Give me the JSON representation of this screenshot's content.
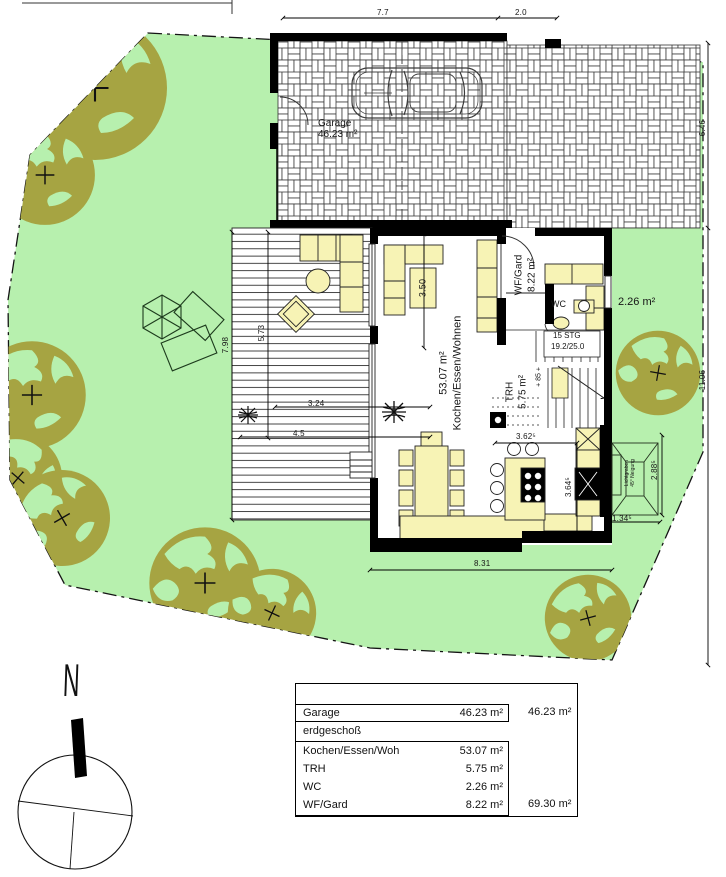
{
  "site": {
    "garage_label": "Garage",
    "garage_area": "46.23 m²",
    "rooms": {
      "living": {
        "area": "53.07 m²",
        "name": "Kochen/Essen/Wohnen"
      },
      "wf_gard": {
        "name": "WF/Gard",
        "area": "8.22 m²"
      },
      "wc": {
        "name": "WC",
        "area": "2.26 m²"
      },
      "trh": {
        "name": "TRH",
        "area": "5.75 m²"
      }
    },
    "stairs": {
      "line1": "15 STG",
      "line2": "19.2/25.0",
      "level_note": "+ 85 +"
    },
    "canopy": {
      "line1": "Lichtgraben",
      "line2": "45° Neigung"
    },
    "compass": "N",
    "dimensions": {
      "garage_width": "7.7",
      "gate_width": "2.0",
      "right_upper": "6.46",
      "right_lower": "11.06",
      "terrace_height": "7.98",
      "terrace_inner": "5.73",
      "terrace_w1": "3.24",
      "terrace_w2": "4.5",
      "living_table": "3.50",
      "kitchen_width": "3.62⁵",
      "kitchen_height": "3.64⁵",
      "house_width": "8.31",
      "canopy_height": "2.88⁵",
      "canopy_width": "1.34⁵"
    }
  },
  "area_table": {
    "garage": {
      "label": "Garage",
      "value": "46.23 m²",
      "total": "46.23 m²"
    },
    "section": "erdgeschoß",
    "rows": [
      {
        "label": "Kochen/Essen/Woh",
        "value": "53.07 m²"
      },
      {
        "label": "TRH",
        "value": "5.75 m²"
      },
      {
        "label": "WC",
        "value": "2.26 m²"
      },
      {
        "label": "WF/Gard",
        "value": "8.22 m²"
      }
    ],
    "floor_total": "69.30 m²"
  },
  "colors": {
    "grass": "#b7f0ae",
    "tree": "#a6a442",
    "furniture": "#f7f3b5"
  }
}
